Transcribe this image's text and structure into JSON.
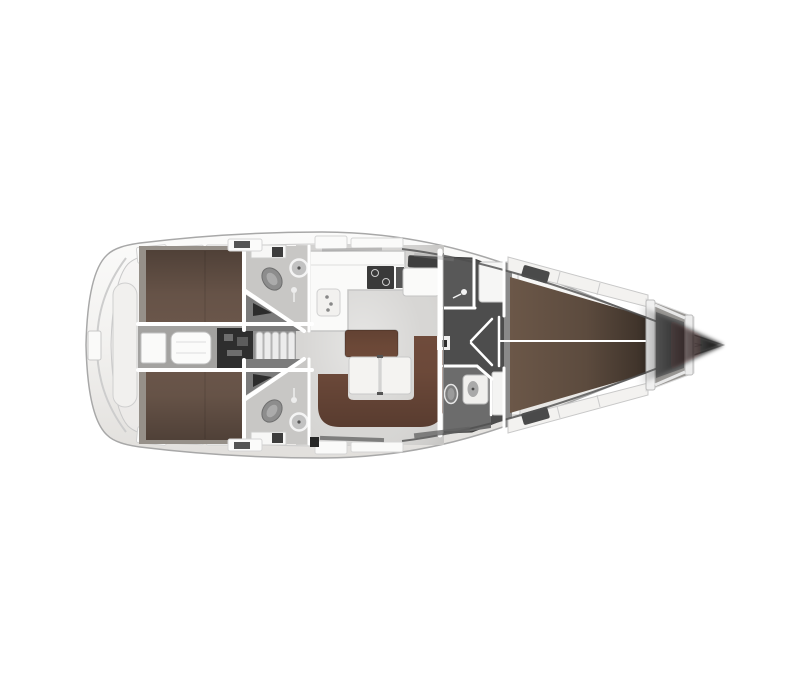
{
  "diagram": {
    "type": "floor-plan",
    "subject": "sailing-yacht-interior-top-view-bow-right",
    "rooms": [
      {
        "id": "stern-platform",
        "label": "stern swim platform"
      },
      {
        "id": "aft-cabin-port",
        "label": "aft double cabin port"
      },
      {
        "id": "aft-cabin-starboard",
        "label": "aft double cabin starboard"
      },
      {
        "id": "aft-head-port",
        "label": "aft head with shower port"
      },
      {
        "id": "aft-head-starboard",
        "label": "aft head with shower starboard"
      },
      {
        "id": "engine-companionway",
        "label": "companionway steps and engine compartment"
      },
      {
        "id": "galley",
        "label": "L-shaped galley with stove and sink"
      },
      {
        "id": "chart-table",
        "label": "chart table navigation station"
      },
      {
        "id": "saloon",
        "label": "saloon with U-settee and table"
      },
      {
        "id": "forward-head",
        "label": "forward head with separate shower"
      },
      {
        "id": "forward-cabin",
        "label": "forward V-berth cabin"
      },
      {
        "id": "anchor-locker",
        "label": "anchor locker"
      }
    ]
  },
  "colors": {
    "page_bg": "#ffffff",
    "wall_white": "#ffffff",
    "cabin_floor": "#969089",
    "corridor_floor": "#a3a2a0",
    "saloon_floor": "#d7d6d4",
    "head_floor": "#c8c7c5",
    "recess_gray": "#7b7b7b",
    "head_dark_floor": "#4d4d4d",
    "shower_floor": "#585858",
    "toilet_room_floor": "#6c6c6c",
    "bed_brown": "#6a564a",
    "fwd_bed_brown": "#6b5748",
    "sofa_brown": "#6f4b3b",
    "table_brown": "#6d4938",
    "furniture_white": "#fafaf9",
    "stove_dark": "#3a3a3a",
    "hatch_dark": "#3f3f3f",
    "engine_dark": "#2e2e2e",
    "fixture_gray": "#8d8d8d",
    "anchor_locker": "#999794"
  }
}
